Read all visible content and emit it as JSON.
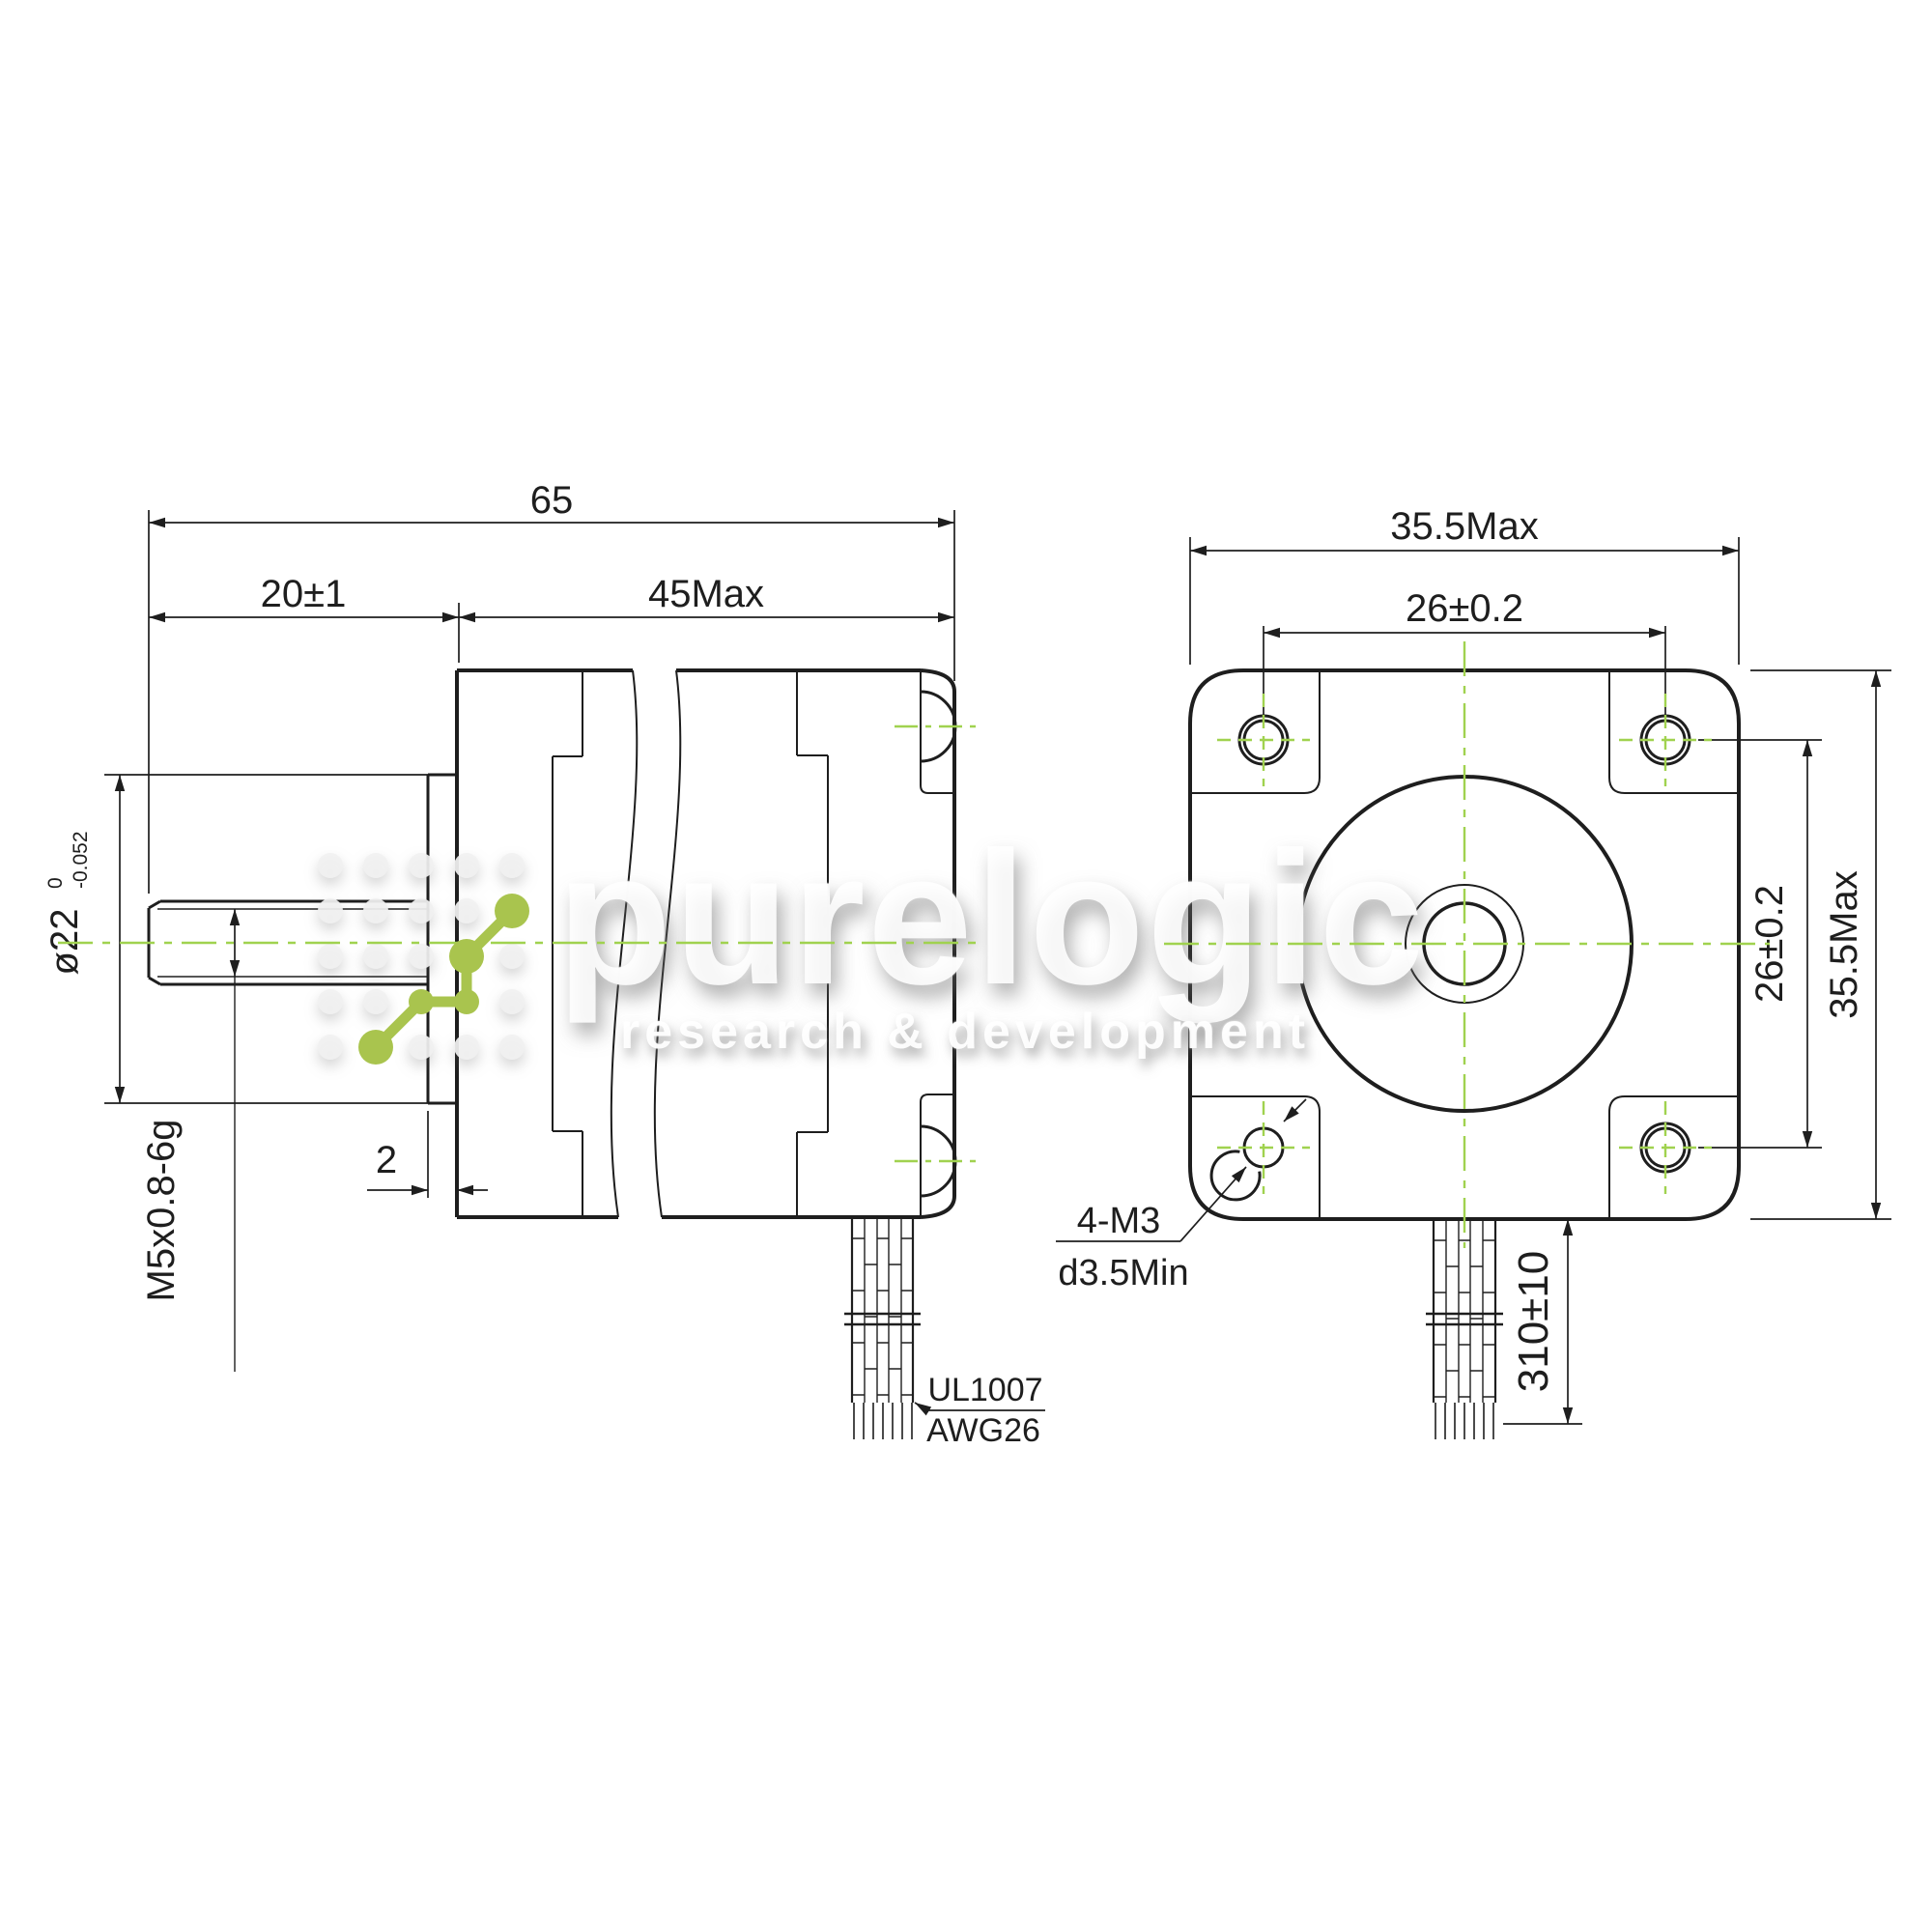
{
  "left": {
    "len_total": "65",
    "len_shaft": "20±1",
    "len_body": "45Max",
    "dia_label": "ø22",
    "tol_up": "0",
    "tol_dn": "-0.052",
    "thread": "M5x0.8-6g",
    "pilot_thickness": "2",
    "wire_type": "UL1007",
    "wire_gauge": "AWG26"
  },
  "right": {
    "width": "35.5Max",
    "hole_spacing_h": "26±0.2",
    "hole_spacing_v": "26±0.2",
    "height": "35.5Max",
    "wire_length": "310±10",
    "holes": "4-M3",
    "hole_depth": "d3.5Min"
  },
  "watermark": {
    "brand": "purelogic",
    "tagline": "research & development"
  },
  "colors": {
    "line": "#1e1e1e",
    "centerline": "#a0d24f",
    "logo_green": "#a9c44e"
  }
}
